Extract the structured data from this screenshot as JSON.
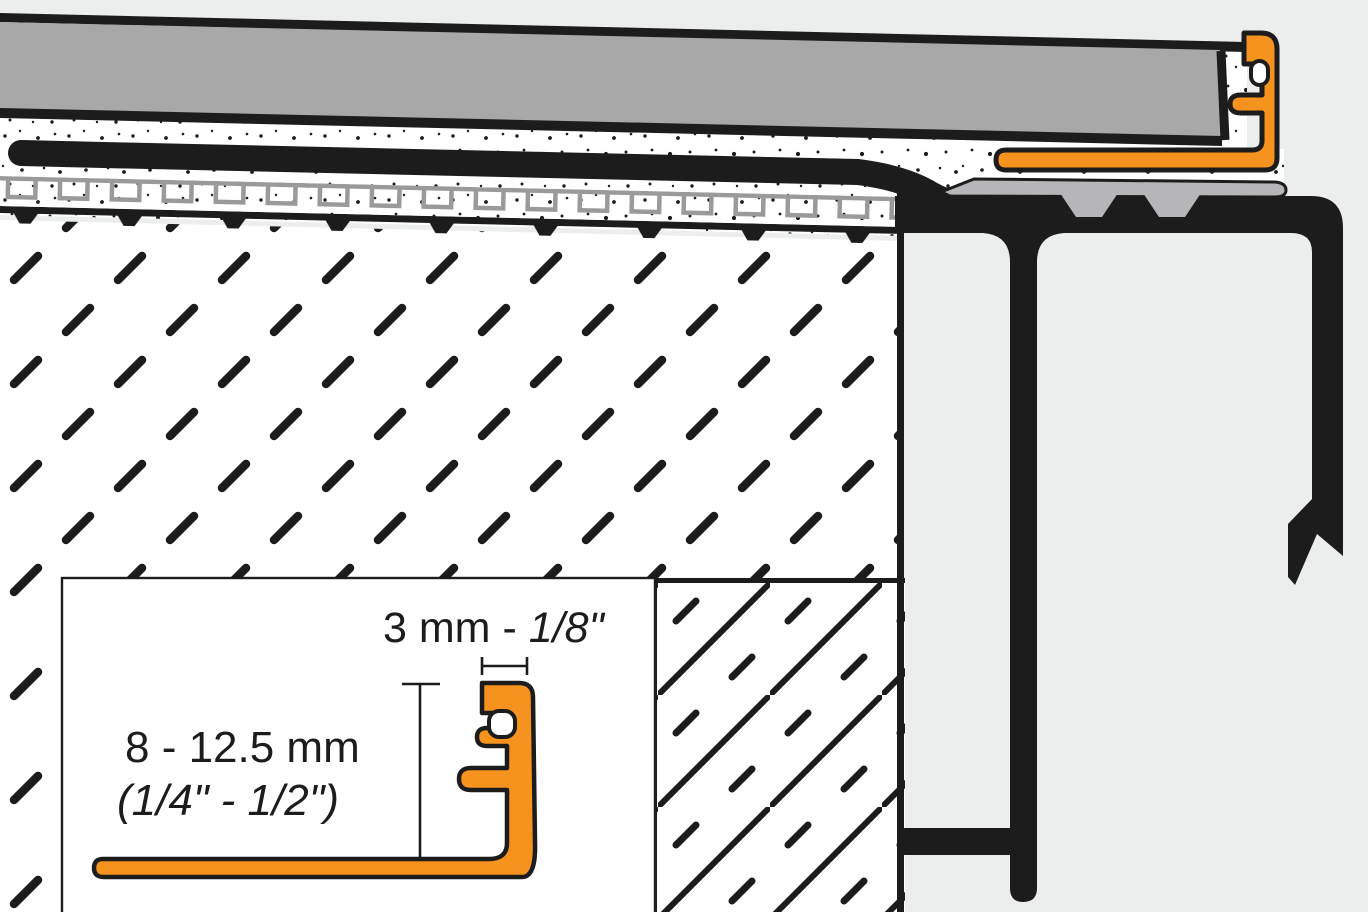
{
  "inset": {
    "width_metric": "3 mm - ",
    "width_imperial": "1/8\"",
    "height_metric": "8 - 12.5 mm",
    "height_imperial": "(1/4\" - 1/2\")"
  },
  "colors": {
    "profile_orange": "#F6921E",
    "tile_gray": "#A8A8A8",
    "support_gray": "#B6B6B9",
    "meander_gray": "#9A9A9A",
    "ink": "#1C1C1C",
    "mortar_white": "#FFFFFF",
    "background": "#ECEEEE"
  }
}
